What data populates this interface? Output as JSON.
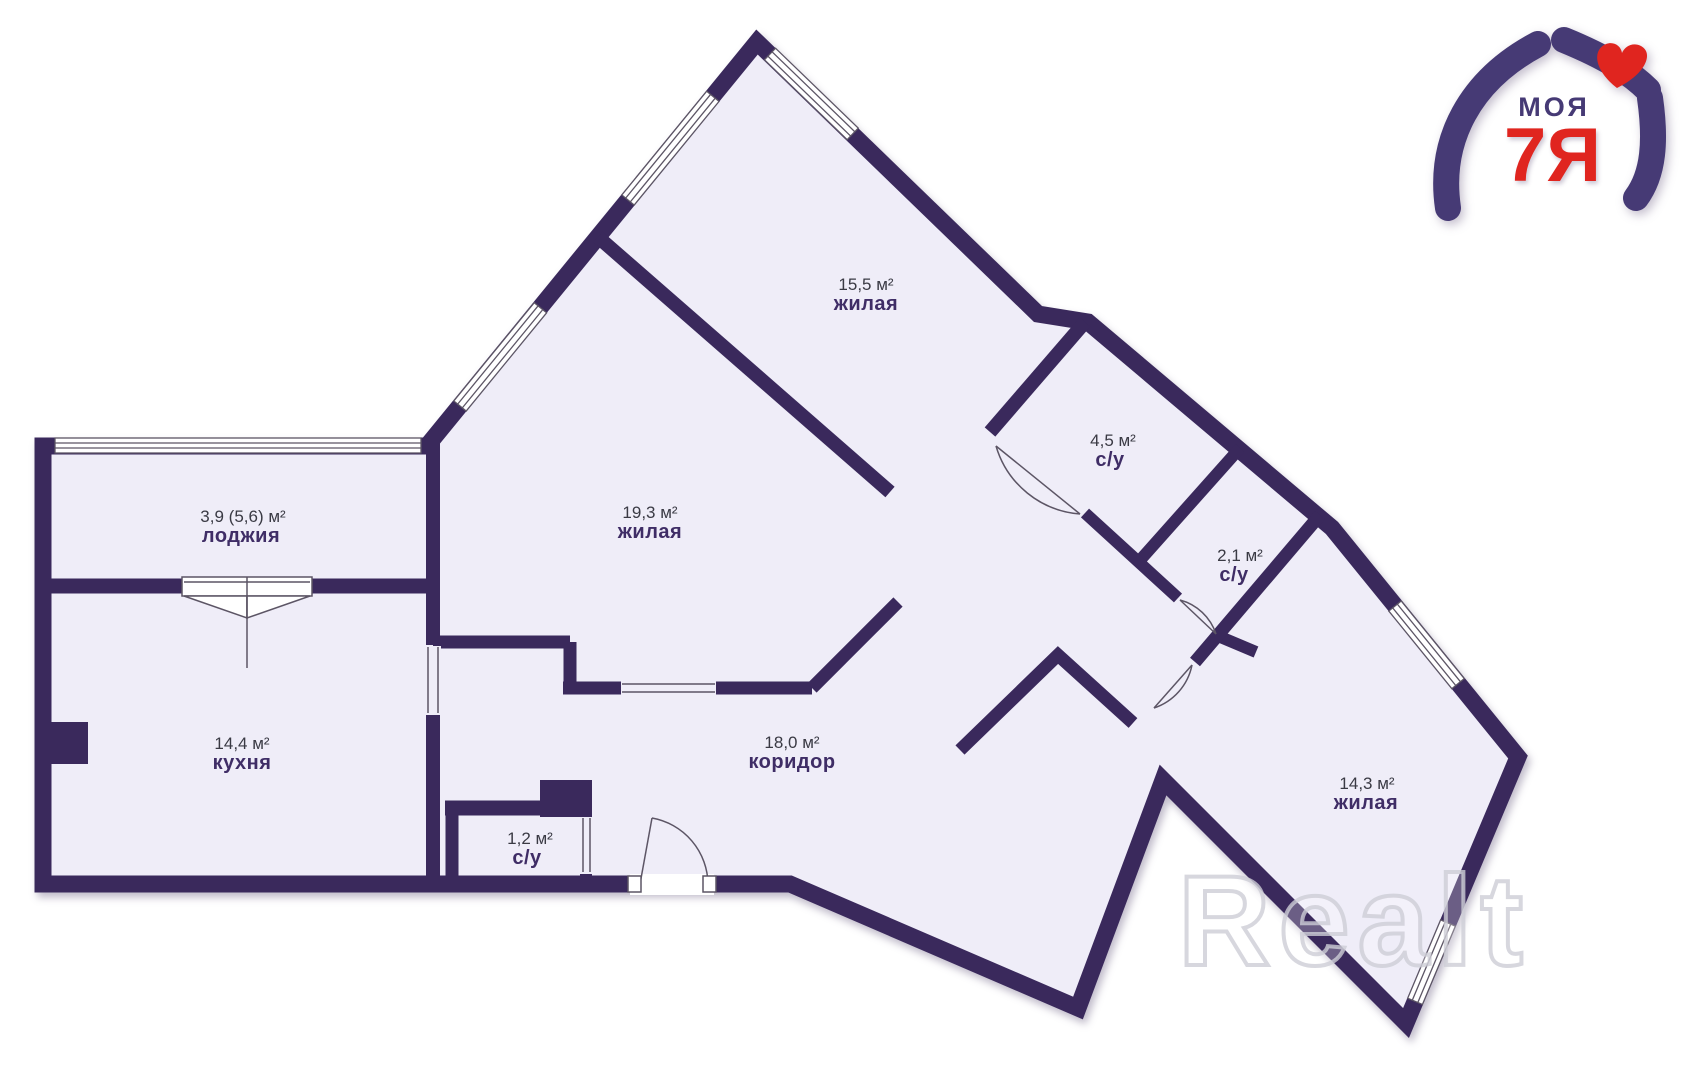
{
  "plan": {
    "background": "#ffffff",
    "wall_color": "#3a295c",
    "room_fill": "#efedf8",
    "thin_line_color": "#5c5565",
    "rooms": [
      {
        "key": "living-15-5",
        "area": "15,5 м²",
        "name": "жилая"
      },
      {
        "key": "living-19-3",
        "area": "19,3 м²",
        "name": "жилая"
      },
      {
        "key": "loggia",
        "area": "3,9 (5,6) м²",
        "name": "лоджия"
      },
      {
        "key": "kitchen",
        "area": "14,4 м²",
        "name": "кухня"
      },
      {
        "key": "corridor",
        "area": "18,0 м²",
        "name": "коридор"
      },
      {
        "key": "bathroom-1-2",
        "area": "1,2 м²",
        "name": "с/у"
      },
      {
        "key": "bathroom-4-5",
        "area": "4,5 м²",
        "name": "с/у"
      },
      {
        "key": "bathroom-2-1",
        "area": "2,1 м²",
        "name": "с/у"
      },
      {
        "key": "living-14-3",
        "area": "14,3 м²",
        "name": "жилая"
      }
    ]
  },
  "logo": {
    "word": "МОЯ",
    "mark": "7Я",
    "purple": "#463a75",
    "red": "#e0251f"
  },
  "watermark": {
    "text": "Realt"
  }
}
